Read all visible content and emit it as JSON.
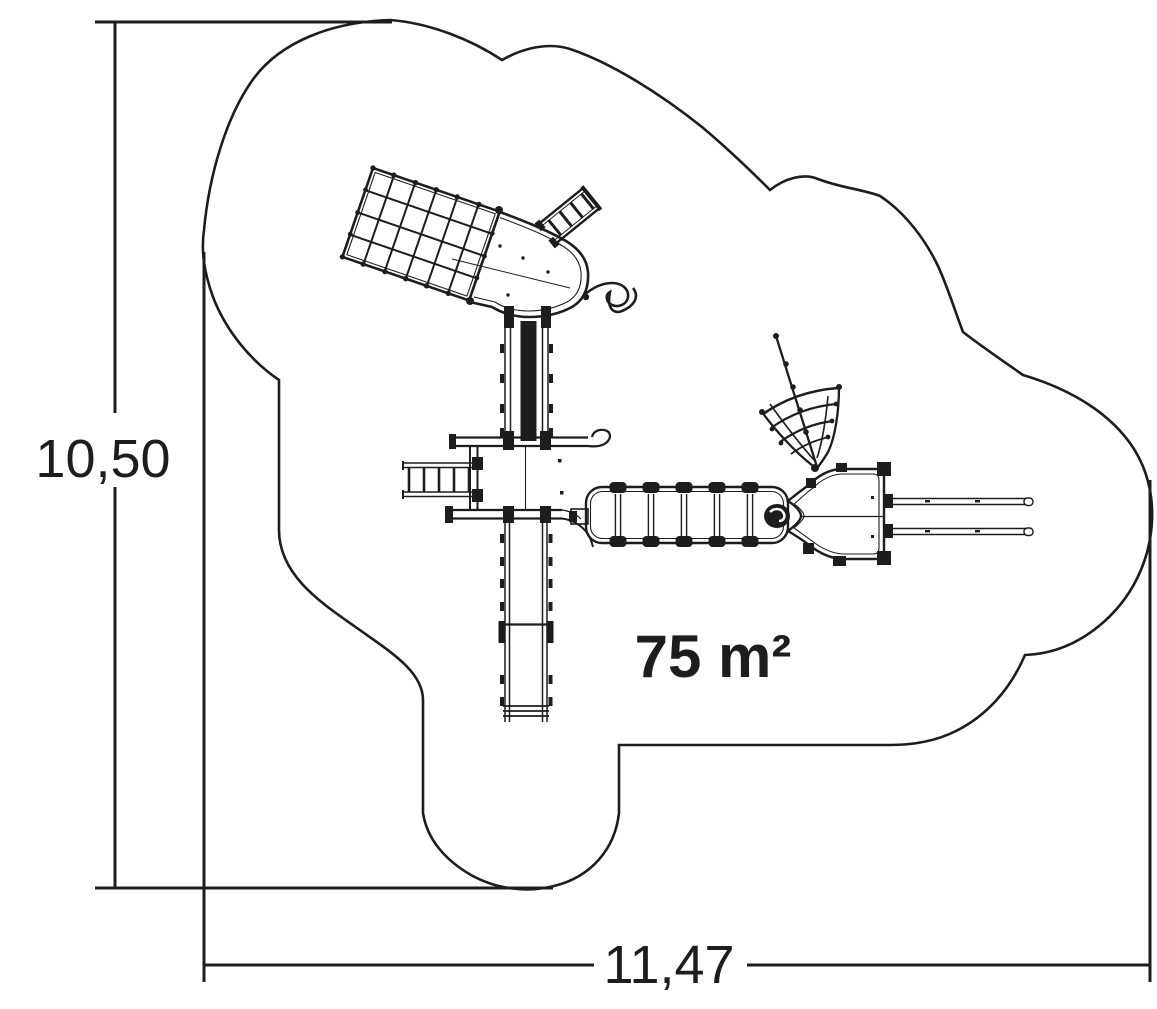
{
  "page": {
    "background_color": "#ffffff",
    "line_color": "#1d1d1b"
  },
  "plan": {
    "area_label": "75 m²",
    "height_dimension_label": "10,50",
    "width_dimension_label": "11,47",
    "elements": [
      "safety-zone-outline",
      "climbing-net",
      "upper-platform",
      "access-ladder",
      "spiral-handle",
      "upper-slide",
      "central-platform",
      "side-ladder",
      "clatter-bridge",
      "lower-platform",
      "fan-climbing-net",
      "parallel-bars",
      "lower-slide"
    ]
  }
}
